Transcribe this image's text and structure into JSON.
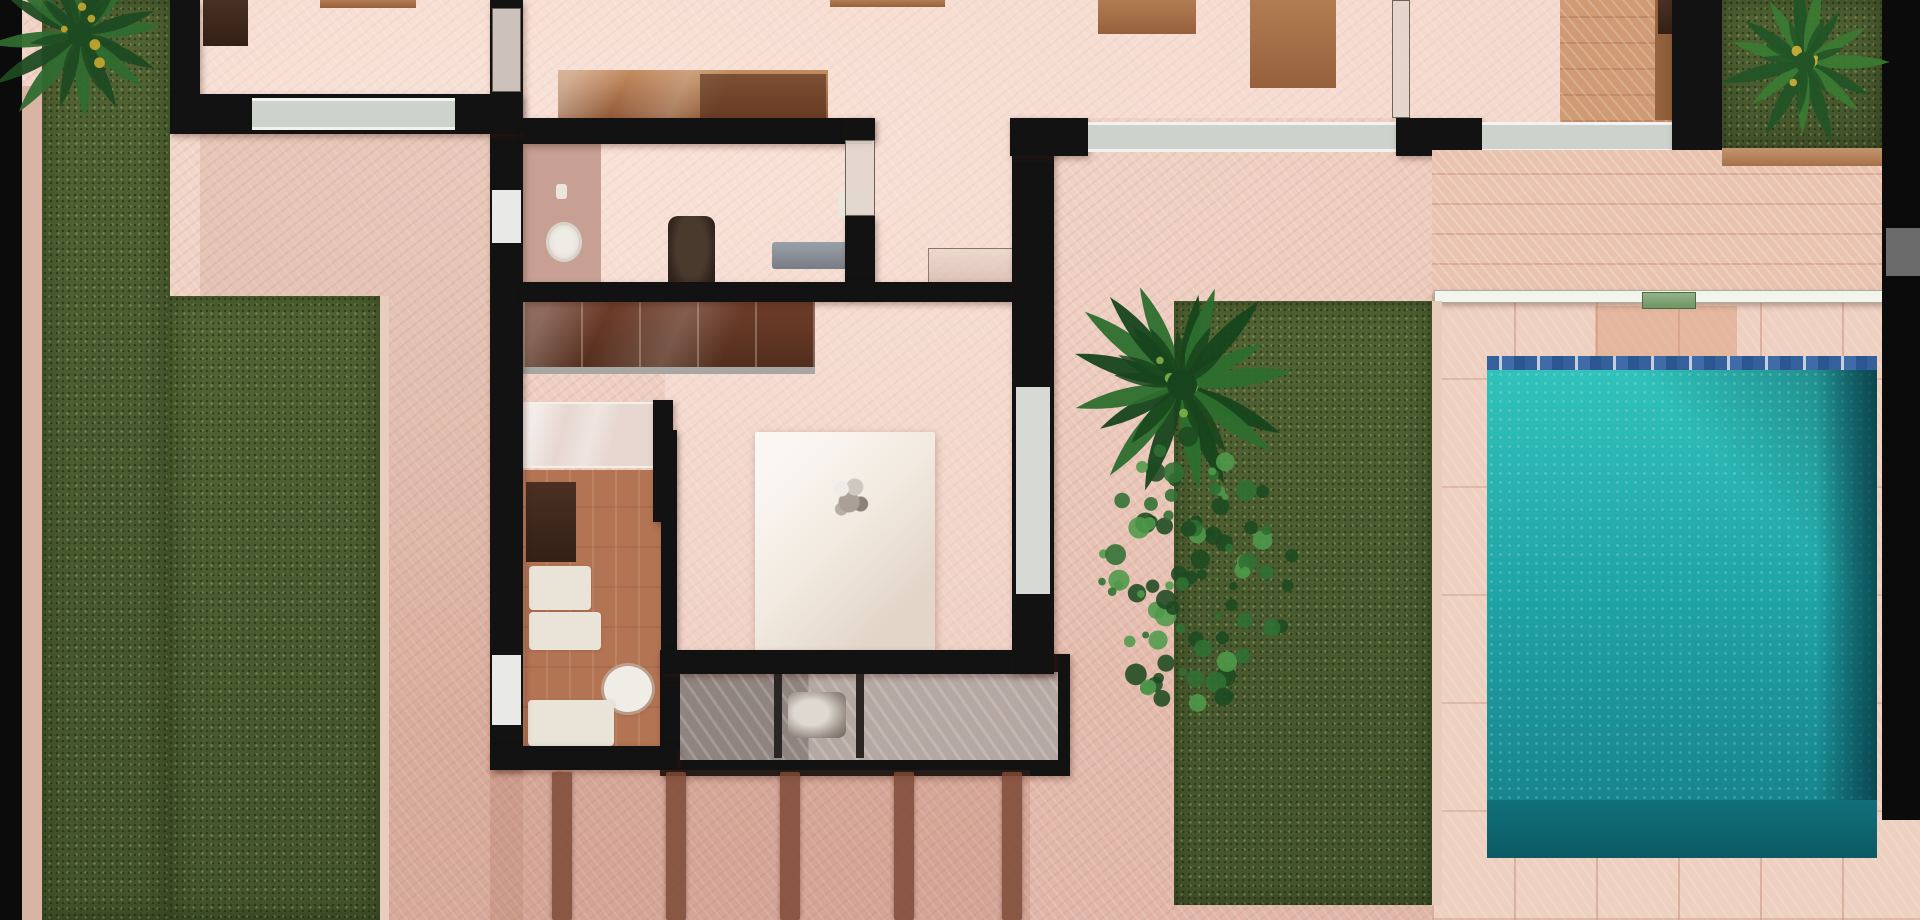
{
  "scene": {
    "description": "Top-down 3D rendered floor plan of a villa: black walls, pink herringbone floors, left lawn strips, poolside lawn with palm and bush, turquoise swimming pool with deck at right",
    "canvas": {
      "width": 1920,
      "height": 920
    },
    "palette": {
      "floor_pink": "#e6c0b1",
      "wall_black": "#121212",
      "window_gray": "#cdd2cc",
      "grass_green": "#5a6a3c",
      "pool_teal": "#25adaa",
      "pool_deep": "#0c5a64",
      "deck_tile": "#eed0c0",
      "terracotta": "#b37453",
      "wood": "#a5714a",
      "canopy_white": "#f3ebe1",
      "gate_green": "#6f9465"
    },
    "elements": [
      {
        "name": "floor-base",
        "type": "floor",
        "x": 0,
        "y": 0,
        "w": 1920,
        "h": 920
      },
      {
        "name": "patio-shade-left",
        "type": "shade",
        "x": 200,
        "y": 124,
        "w": 323,
        "h": 796
      },
      {
        "name": "room-study-floor",
        "type": "room",
        "x": 200,
        "y": 0,
        "w": 290,
        "h": 96
      },
      {
        "name": "room-kitchen-floor",
        "type": "room",
        "x": 523,
        "y": 0,
        "w": 349,
        "h": 120
      },
      {
        "name": "room-living-floor",
        "type": "room",
        "x": 872,
        "y": 0,
        "w": 520,
        "h": 118
      },
      {
        "name": "room-living-floor-ext",
        "type": "room",
        "x": 875,
        "y": 118,
        "w": 137,
        "h": 166
      },
      {
        "name": "room-dressing-floor",
        "type": "room",
        "x": 523,
        "y": 144,
        "w": 352,
        "h": 140
      },
      {
        "name": "room-bedroom2-floor",
        "type": "room",
        "x": 1410,
        "y": 0,
        "w": 262,
        "h": 122
      },
      {
        "name": "room-bedroom-floor",
        "type": "room",
        "x": 665,
        "y": 302,
        "w": 347,
        "h": 350
      },
      {
        "name": "study-desk",
        "type": "wooddark",
        "x": 203,
        "y": 0,
        "w": 45,
        "h": 46
      },
      {
        "name": "study-shelf",
        "type": "wood",
        "x": 320,
        "y": 0,
        "w": 96,
        "h": 8
      },
      {
        "name": "living-wood-strip",
        "type": "wood",
        "x": 830,
        "y": 0,
        "w": 115,
        "h": 7
      },
      {
        "name": "dining-table-a",
        "type": "wood",
        "x": 1098,
        "y": 0,
        "w": 98,
        "h": 34
      },
      {
        "name": "dining-table-b",
        "type": "wood",
        "x": 1250,
        "y": 0,
        "w": 86,
        "h": 88
      },
      {
        "name": "kitchen-cabinet",
        "type": "cabinet",
        "x": 558,
        "y": 70,
        "w": 270,
        "h": 52
      },
      {
        "name": "kitchen-cabinet-dark",
        "type": "cabinetdark",
        "x": 700,
        "y": 74,
        "w": 126,
        "h": 46
      },
      {
        "name": "bedroom2-wood-floor",
        "type": "woodfloor",
        "x": 1560,
        "y": 0,
        "w": 112,
        "h": 122
      },
      {
        "name": "bedroom2-cabinet",
        "type": "woodside",
        "x": 1655,
        "y": 0,
        "w": 42,
        "h": 120
      },
      {
        "name": "bedroom2-cabinet-dark",
        "type": "wooddark",
        "x": 1658,
        "y": 0,
        "w": 36,
        "h": 34
      },
      {
        "name": "sink-counter",
        "type": "counter",
        "x": 523,
        "y": 144,
        "w": 78,
        "h": 140
      },
      {
        "name": "sink-basin",
        "type": "basin",
        "x": 546,
        "y": 222,
        "w": 36,
        "h": 40
      },
      {
        "name": "soap-dish",
        "type": "white",
        "x": 556,
        "y": 184,
        "w": 11,
        "h": 15
      },
      {
        "name": "office-chair",
        "type": "chairdark",
        "x": 668,
        "y": 216,
        "w": 47,
        "h": 78
      },
      {
        "name": "bench-gray",
        "type": "benchgray",
        "x": 772,
        "y": 242,
        "w": 76,
        "h": 27
      },
      {
        "name": "stool-white",
        "type": "white",
        "x": 838,
        "y": 191,
        "w": 30,
        "h": 28
      },
      {
        "name": "tv-console-glass",
        "type": "consoleglass",
        "x": 928,
        "y": 248,
        "w": 114,
        "h": 52
      },
      {
        "name": "bathroom-terracotta-floor",
        "type": "terracotta",
        "x": 523,
        "y": 470,
        "w": 140,
        "h": 278
      },
      {
        "name": "walkin-cabinet",
        "type": "wooddark",
        "x": 526,
        "y": 482,
        "w": 50,
        "h": 80
      },
      {
        "name": "walkin-bench-a",
        "type": "whitesoft",
        "x": 529,
        "y": 566,
        "w": 62,
        "h": 44
      },
      {
        "name": "walkin-bench-b",
        "type": "whitesoft",
        "x": 529,
        "y": 612,
        "w": 72,
        "h": 38
      },
      {
        "name": "toilet",
        "type": "toilet",
        "x": 604,
        "y": 666,
        "w": 48,
        "h": 46
      },
      {
        "name": "bath-mat",
        "type": "whitesoft",
        "x": 528,
        "y": 700,
        "w": 86,
        "h": 46
      },
      {
        "name": "shower-glassbox",
        "type": "glass",
        "x": 523,
        "y": 402,
        "w": 137,
        "h": 66
      },
      {
        "name": "shower-frame",
        "type": "wall",
        "x": 653,
        "y": 400,
        "w": 20,
        "h": 122
      },
      {
        "name": "wardrobe",
        "type": "wardrobe",
        "x": 523,
        "y": 302,
        "w": 292,
        "h": 72
      },
      {
        "name": "bed-canopy",
        "type": "canopy",
        "x": 755,
        "y": 432,
        "w": 180,
        "h": 222
      },
      {
        "name": "chandelier",
        "type": "chandelier",
        "x": 827,
        "y": 473,
        "w": 48,
        "h": 50
      },
      {
        "name": "wine-cabinet-frame",
        "type": "wall",
        "x": 660,
        "y": 654,
        "w": 410,
        "h": 122
      },
      {
        "name": "wine-cabinet-glass",
        "type": "wineglass",
        "x": 680,
        "y": 672,
        "w": 378,
        "h": 88
      },
      {
        "name": "wine-divider-a",
        "type": "bar2",
        "x": 774,
        "y": 672,
        "w": 8,
        "h": 86
      },
      {
        "name": "wine-divider-b",
        "type": "bar2",
        "x": 856,
        "y": 672,
        "w": 8,
        "h": 86
      },
      {
        "name": "wine-item",
        "type": "metallic",
        "x": 788,
        "y": 692,
        "w": 58,
        "h": 46
      },
      {
        "name": "wall-west",
        "type": "wall",
        "x": 490,
        "y": 0,
        "w": 33,
        "h": 770
      },
      {
        "name": "wall-west-glassdoor",
        "type": "glassdoor",
        "x": 492,
        "y": 8,
        "w": 29,
        "h": 84
      },
      {
        "name": "wall-west-window",
        "type": "windowwhite",
        "x": 492,
        "y": 190,
        "w": 29,
        "h": 53
      },
      {
        "name": "wall-west-door",
        "type": "windowwhite",
        "x": 492,
        "y": 655,
        "w": 29,
        "h": 70
      },
      {
        "name": "wall-study-west",
        "type": "wall",
        "x": 170,
        "y": 0,
        "w": 30,
        "h": 126
      },
      {
        "name": "wall-study-south",
        "type": "wall",
        "x": 170,
        "y": 94,
        "w": 353,
        "h": 40
      },
      {
        "name": "window-study",
        "type": "window",
        "x": 252,
        "y": 98,
        "w": 203,
        "h": 32
      },
      {
        "name": "wall-kitchen-south",
        "type": "wall",
        "x": 523,
        "y": 118,
        "w": 349,
        "h": 26
      },
      {
        "name": "wall-glass-mid-a",
        "type": "wall",
        "x": 845,
        "y": 118,
        "w": 30,
        "h": 22
      },
      {
        "name": "glass-mid",
        "type": "glassdoor",
        "x": 845,
        "y": 140,
        "w": 30,
        "h": 76
      },
      {
        "name": "wall-glass-mid-b",
        "type": "wall",
        "x": 845,
        "y": 216,
        "w": 30,
        "h": 80
      },
      {
        "name": "wall-dressing-south",
        "type": "wall",
        "x": 523,
        "y": 282,
        "w": 489,
        "h": 20
      },
      {
        "name": "wall-walkin-east",
        "type": "wall",
        "x": 661,
        "y": 430,
        "w": 16,
        "h": 226
      },
      {
        "name": "wall-bath-south",
        "type": "wall",
        "x": 490,
        "y": 746,
        "w": 188,
        "h": 24
      },
      {
        "name": "wall-bedroom-south",
        "type": "wall",
        "x": 660,
        "y": 650,
        "w": 394,
        "h": 24
      },
      {
        "name": "wall-east",
        "type": "wall",
        "x": 1012,
        "y": 118,
        "w": 42,
        "h": 556
      },
      {
        "name": "door-east-gray",
        "type": "doorgray",
        "x": 1016,
        "y": 387,
        "w": 34,
        "h": 207
      },
      {
        "name": "wall-north-a",
        "type": "wall",
        "x": 1010,
        "y": 118,
        "w": 78,
        "h": 38
      },
      {
        "name": "window-living",
        "type": "window",
        "x": 1088,
        "y": 122,
        "w": 308,
        "h": 30
      },
      {
        "name": "wall-north-b",
        "type": "wall",
        "x": 1396,
        "y": 118,
        "w": 86,
        "h": 38
      },
      {
        "name": "window-bedroom2",
        "type": "window",
        "x": 1482,
        "y": 122,
        "w": 200,
        "h": 30
      },
      {
        "name": "wall-north-c",
        "type": "wall",
        "x": 1682,
        "y": 118,
        "w": 40,
        "h": 38
      },
      {
        "name": "partition-glass",
        "type": "glassdoor",
        "x": 1392,
        "y": 0,
        "w": 18,
        "h": 118
      },
      {
        "name": "wall-bedroom2-east",
        "type": "wall",
        "x": 1672,
        "y": 0,
        "w": 50,
        "h": 164
      },
      {
        "name": "wall-topright-seg",
        "type": "wall",
        "x": 1792,
        "y": 164,
        "w": 102,
        "h": 26
      },
      {
        "name": "deck-planks",
        "type": "deck",
        "x": 1432,
        "y": 150,
        "w": 450,
        "h": 145
      },
      {
        "name": "pool-deck-tiles",
        "type": "decktiles",
        "x": 1432,
        "y": 295,
        "w": 488,
        "h": 625
      },
      {
        "name": "deck-warm-tile",
        "type": "deckwarm",
        "x": 1595,
        "y": 306,
        "w": 142,
        "h": 52
      },
      {
        "name": "pool-mosaic-edge",
        "type": "mosaic",
        "x": 1487,
        "y": 356,
        "w": 390,
        "h": 15
      },
      {
        "name": "pool-water",
        "type": "pool",
        "x": 1487,
        "y": 370,
        "w": 390,
        "h": 432
      },
      {
        "name": "pool-right-shadow",
        "type": "pooldark",
        "x": 1817,
        "y": 370,
        "w": 60,
        "h": 432
      },
      {
        "name": "pool-bottom",
        "type": "poolfloor",
        "x": 1487,
        "y": 800,
        "w": 390,
        "h": 58
      },
      {
        "name": "glass-fence",
        "type": "fence",
        "x": 1434,
        "y": 290,
        "w": 452,
        "h": 13
      },
      {
        "name": "fence-gate",
        "type": "gate",
        "x": 1642,
        "y": 292,
        "w": 54,
        "h": 17
      },
      {
        "name": "grass-strip-left",
        "type": "grass",
        "x": 42,
        "y": 0,
        "w": 128,
        "h": 920
      },
      {
        "name": "grass-block-left",
        "type": "grass",
        "x": 168,
        "y": 296,
        "w": 212,
        "h": 624
      },
      {
        "name": "grass-edge-left",
        "type": "edge",
        "x": 380,
        "y": 296,
        "w": 9,
        "h": 624
      },
      {
        "name": "grass-poolside",
        "type": "grass",
        "x": 1174,
        "y": 301,
        "w": 258,
        "h": 604
      },
      {
        "name": "grass-edge-pool",
        "type": "edge",
        "x": 1432,
        "y": 301,
        "w": 10,
        "h": 604
      },
      {
        "name": "grass-topright",
        "type": "grass",
        "x": 1722,
        "y": 0,
        "w": 160,
        "h": 150
      },
      {
        "name": "deck-strip-topright",
        "type": "woodstrip",
        "x": 1722,
        "y": 148,
        "w": 160,
        "h": 18
      },
      {
        "name": "path-left",
        "type": "path",
        "x": 22,
        "y": 86,
        "w": 20,
        "h": 834
      },
      {
        "name": "left-boundary-bar",
        "type": "bar",
        "x": 0,
        "y": 0,
        "w": 22,
        "h": 920
      },
      {
        "name": "right-boundary-bar",
        "type": "bar",
        "x": 1882,
        "y": 0,
        "w": 38,
        "h": 820
      },
      {
        "name": "gray-wall-seg",
        "type": "grayseg",
        "x": 1886,
        "y": 228,
        "w": 34,
        "h": 48
      },
      {
        "name": "pergola-shade",
        "type": "shade2",
        "x": 490,
        "y": 770,
        "w": 540,
        "h": 150
      },
      {
        "name": "pergola-beam-1",
        "type": "beam",
        "x": 552,
        "y": 772,
        "w": 20,
        "h": 148
      },
      {
        "name": "pergola-beam-2",
        "type": "beam",
        "x": 666,
        "y": 772,
        "w": 20,
        "h": 148
      },
      {
        "name": "pergola-beam-3",
        "type": "beam",
        "x": 780,
        "y": 772,
        "w": 20,
        "h": 148
      },
      {
        "name": "pergola-beam-4",
        "type": "beam",
        "x": 894,
        "y": 772,
        "w": 20,
        "h": 148
      },
      {
        "name": "pergola-beam-5",
        "type": "beam",
        "x": 1002,
        "y": 772,
        "w": 20,
        "h": 148
      }
    ],
    "palms": [
      {
        "name": "palm-top-left",
        "cx": 80,
        "cy": 35,
        "r": 100,
        "fronds": 16,
        "dark": "#1e4a22",
        "mid": "#2f6b2f",
        "accent": "#c8a830",
        "seed": 3
      },
      {
        "name": "palm-top-right",
        "cx": 1805,
        "cy": 62,
        "r": 85,
        "fronds": 15,
        "dark": "#225426",
        "mid": "#3a7a33",
        "accent": "#d0b038",
        "seed": 7
      },
      {
        "name": "palm-poolside",
        "cx": 1182,
        "cy": 385,
        "r": 125,
        "fronds": 17,
        "dark": "#17441c",
        "mid": "#2c6e2d",
        "accent": "#7fae4a",
        "seed": 11
      }
    ],
    "bushes": [
      {
        "name": "tree-poolside",
        "cx": 1195,
        "cy": 575,
        "rx": 105,
        "ry": 150,
        "dots": 95,
        "dark": "#1c4a20",
        "mid": "#2f7032",
        "light": "#4f9a4a",
        "seed": 5
      }
    ]
  }
}
